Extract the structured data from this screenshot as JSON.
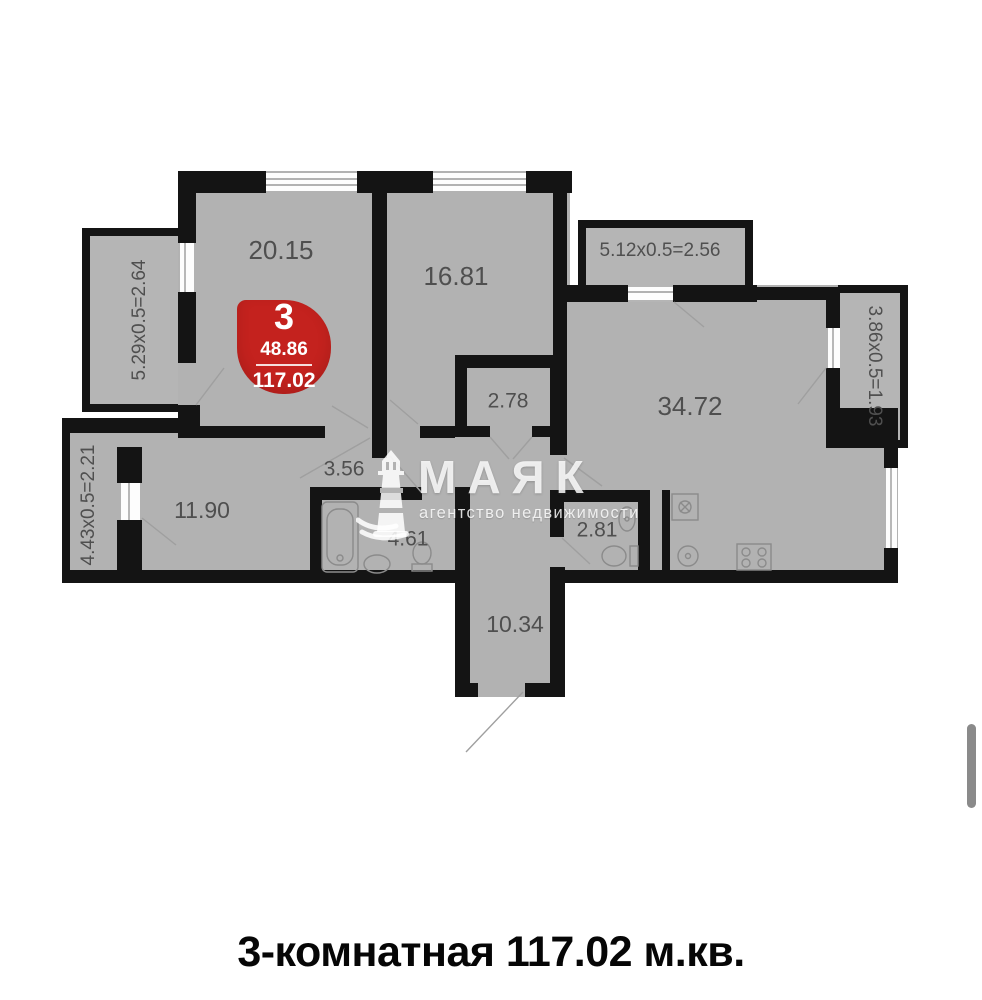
{
  "floorplan": {
    "wall_color": "#141414",
    "floor_color": "#b2b2b2",
    "label_color": "#4f4f4f",
    "rooms": [
      {
        "name": "bedroom-top-left",
        "label": "20.15"
      },
      {
        "name": "bedroom-top-mid",
        "label": "16.81"
      },
      {
        "name": "closet",
        "label": "2.78"
      },
      {
        "name": "hallway",
        "label": "3.56"
      },
      {
        "name": "kitchen-living",
        "label": "34.72"
      },
      {
        "name": "bedroom-left",
        "label": "11.90"
      },
      {
        "name": "bathroom",
        "label": "4.61"
      },
      {
        "name": "wc",
        "label": "2.81"
      },
      {
        "name": "entry-corridor",
        "label": "10.34"
      }
    ],
    "balconies": [
      {
        "name": "balcony-top-right",
        "label": "5.12x0.5=2.56"
      },
      {
        "name": "balcony-right",
        "label": "3.86x0.5=1.93"
      },
      {
        "name": "balcony-left-upper",
        "label": "5.29x0.5=2.64"
      },
      {
        "name": "balcony-left-lower",
        "label": "4.43x0.5=2.21"
      }
    ]
  },
  "badge": {
    "rooms_count": "3",
    "living_area": "48.86",
    "total_area": "117.02",
    "color": "#c4221e"
  },
  "watermark": {
    "brand": "МАЯК",
    "tagline": "агентство недвижимости"
  },
  "caption": {
    "text": "3-комнатная 117.02 м.кв."
  }
}
